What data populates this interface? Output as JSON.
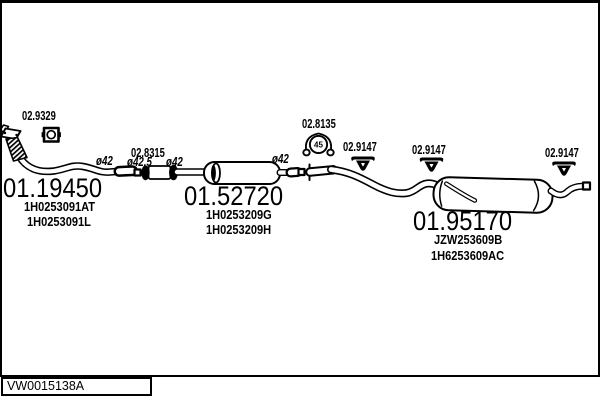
{
  "diagram": {
    "catalog_code": "VW0015138A",
    "clamp_size": "45",
    "labels": {
      "gasket": "02.9329",
      "coupling": "02.8315",
      "clamp": "02.8135",
      "hanger": "02.9147",
      "dia_42": "ø42",
      "dia_42_5": "ø42.5"
    },
    "parts": {
      "front_pipe": {
        "number": "01.19450",
        "oem1": "1H0253091AT",
        "oem2": "1H0253091L"
      },
      "centre_muffler": {
        "number": "01.52720",
        "oem1": "1H0253209G",
        "oem2": "1H0253209H"
      },
      "rear_muffler": {
        "number": "01.95170",
        "oem1": "JZW253609B",
        "oem2": "1H6253609AC"
      }
    }
  },
  "colors": {
    "ink": "#000000",
    "paper": "#ffffff"
  }
}
